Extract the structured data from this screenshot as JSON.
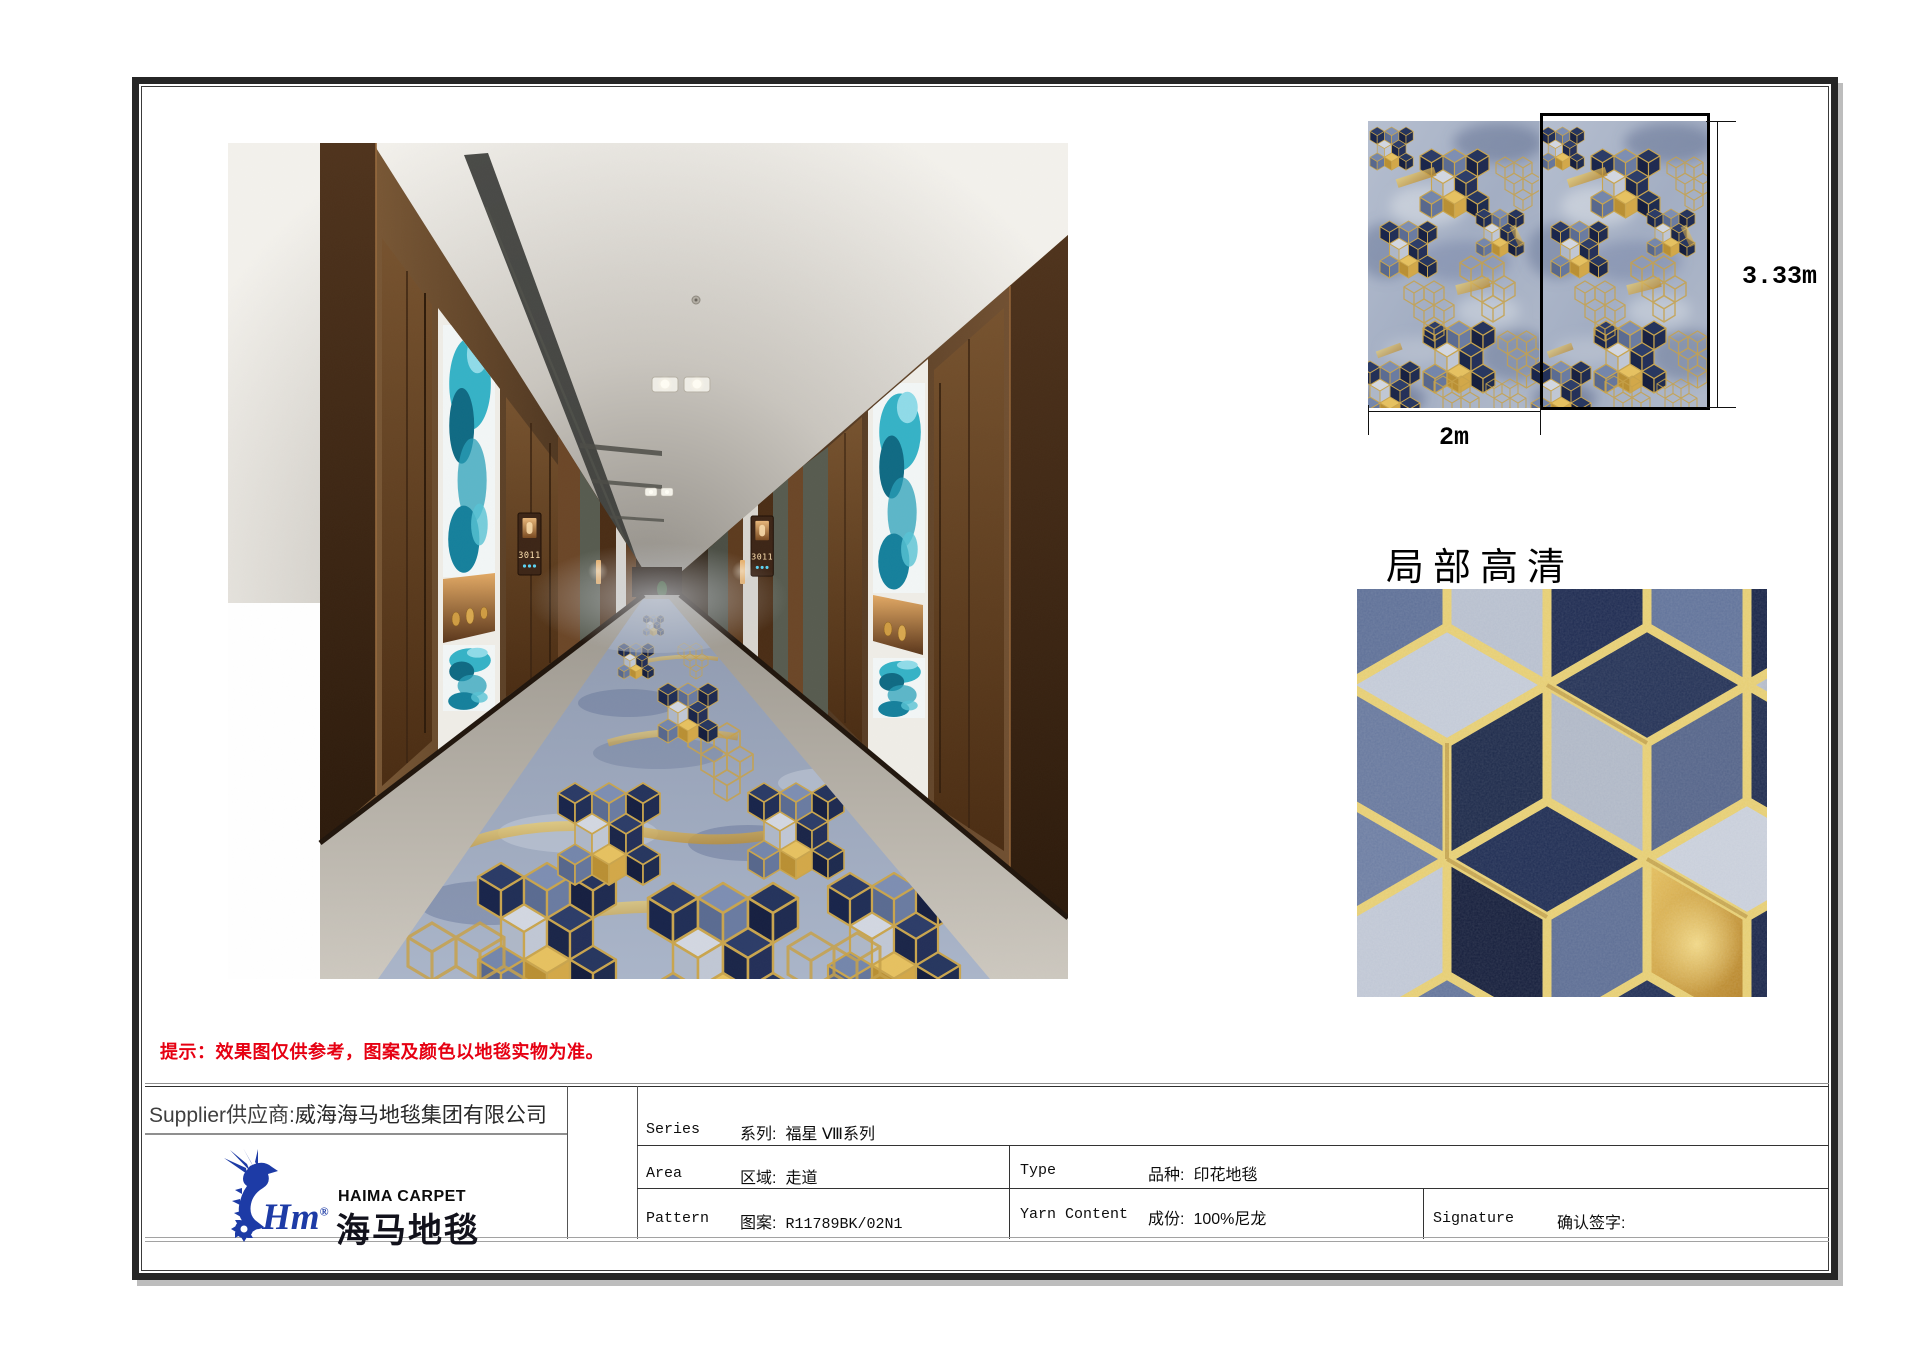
{
  "notice": {
    "text": "提示：效果图仅供参考，图案及颜色以地毯实物为准。"
  },
  "detail_view": {
    "title": "局部高清"
  },
  "swatch": {
    "width_label": "2m",
    "height_label": "3.33m"
  },
  "corridor": {
    "door_sign": "3011"
  },
  "supplier": {
    "label_en": "Supplier",
    "label_zh": "供应商:",
    "name": "威海海马地毯集团有限公司"
  },
  "brand": {
    "logo_en": "HAIMA CARPET",
    "logo_zh": "海马地毯",
    "script": "Hm",
    "registered": "®"
  },
  "spec": {
    "series": {
      "en": "Series",
      "zh": "系列:",
      "value": "福星 Ⅷ系列"
    },
    "area": {
      "en": "Area",
      "zh": "区域:",
      "value": "走道"
    },
    "type": {
      "en": "Type",
      "zh": "品种:",
      "value": "印花地毯"
    },
    "pattern": {
      "en": "Pattern",
      "zh": "图案:",
      "value": "R11789BK/02N1"
    },
    "yarn": {
      "en": "Yarn Content",
      "zh": "成份:",
      "value": "100%尼龙"
    },
    "signature": {
      "en": "Signature",
      "zh": "确认签字:",
      "value": ""
    }
  },
  "palette": {
    "notice_red": "#e60012",
    "brand_blue": "#1d3ba6",
    "carpet_navy": "#1e2c52",
    "carpet_slate": "#67789e",
    "carpet_silver": "#c3cad8",
    "carpet_gold": "#d4aa4e",
    "artwork_teal": "#2aa7bd",
    "wood_brown": "#6e4a2b",
    "frame_black": "#262626"
  }
}
